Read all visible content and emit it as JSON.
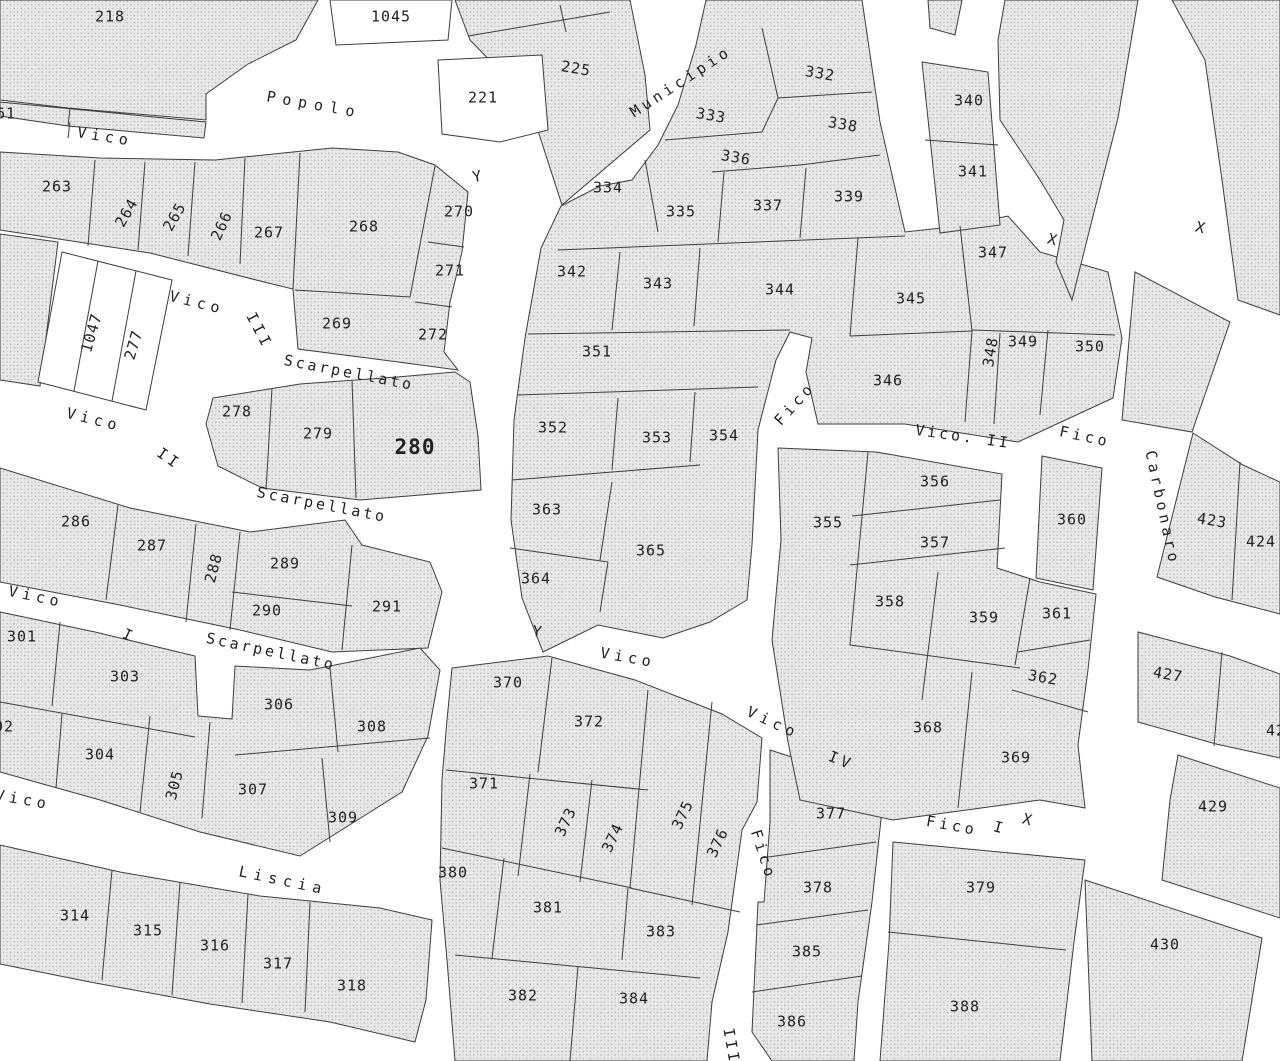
{
  "map": {
    "title": "cadastral-parcel-map",
    "background": "#ffffff",
    "boundary_line_color": "#3d3d3d",
    "hatch_base_color": "#e8e8e8",
    "hatch_dot_color": "#a8a8a8",
    "label_color": "#1f1f1f",
    "parcel_labels": [
      {
        "text": "218",
        "x": 110,
        "y": 17,
        "rot": 0
      },
      {
        "text": "1045",
        "x": 391,
        "y": 17,
        "rot": 0
      },
      {
        "text": "225",
        "x": 576,
        "y": 69,
        "rot": 10
      },
      {
        "text": "221",
        "x": 483,
        "y": 98,
        "rot": 0
      },
      {
        "text": "61",
        "x": 6,
        "y": 114,
        "rot": 0
      },
      {
        "text": "332",
        "x": 820,
        "y": 74,
        "rot": 10
      },
      {
        "text": "333",
        "x": 711,
        "y": 116,
        "rot": 10
      },
      {
        "text": "338",
        "x": 843,
        "y": 125,
        "rot": 10
      },
      {
        "text": "336",
        "x": 736,
        "y": 158,
        "rot": 10
      },
      {
        "text": "334",
        "x": 608,
        "y": 188,
        "rot": 0
      },
      {
        "text": "335",
        "x": 681,
        "y": 212,
        "rot": 0
      },
      {
        "text": "337",
        "x": 768,
        "y": 206,
        "rot": 0
      },
      {
        "text": "339",
        "x": 849,
        "y": 197,
        "rot": 0
      },
      {
        "text": "340",
        "x": 969,
        "y": 101,
        "rot": 0
      },
      {
        "text": "341",
        "x": 973,
        "y": 172,
        "rot": 0
      },
      {
        "text": "263",
        "x": 57,
        "y": 187,
        "rot": 0
      },
      {
        "text": "264",
        "x": 127,
        "y": 213,
        "rot": -60
      },
      {
        "text": "265",
        "x": 175,
        "y": 217,
        "rot": -60
      },
      {
        "text": "266",
        "x": 222,
        "y": 226,
        "rot": -65
      },
      {
        "text": "267",
        "x": 269,
        "y": 233,
        "rot": 0
      },
      {
        "text": "268",
        "x": 364,
        "y": 227,
        "rot": 0
      },
      {
        "text": "270",
        "x": 459,
        "y": 212,
        "rot": 0
      },
      {
        "text": "271",
        "x": 450,
        "y": 271,
        "rot": 0
      },
      {
        "text": "272",
        "x": 433,
        "y": 335,
        "rot": 0
      },
      {
        "text": "269",
        "x": 337,
        "y": 324,
        "rot": 0
      },
      {
        "text": "342",
        "x": 572,
        "y": 272,
        "rot": 0
      },
      {
        "text": "343",
        "x": 658,
        "y": 284,
        "rot": 0
      },
      {
        "text": "344",
        "x": 780,
        "y": 290,
        "rot": 0
      },
      {
        "text": "345",
        "x": 911,
        "y": 299,
        "rot": 0
      },
      {
        "text": "347",
        "x": 993,
        "y": 253,
        "rot": 0
      },
      {
        "text": "346",
        "x": 888,
        "y": 381,
        "rot": 0
      },
      {
        "text": "348",
        "x": 991,
        "y": 352,
        "rot": -80
      },
      {
        "text": "349",
        "x": 1023,
        "y": 342,
        "rot": 0
      },
      {
        "text": "350",
        "x": 1090,
        "y": 347,
        "rot": 0
      },
      {
        "text": "1047",
        "x": 92,
        "y": 333,
        "rot": -74
      },
      {
        "text": "277",
        "x": 134,
        "y": 345,
        "rot": -74
      },
      {
        "text": "351",
        "x": 597,
        "y": 352,
        "rot": 0
      },
      {
        "text": "352",
        "x": 553,
        "y": 428,
        "rot": 0
      },
      {
        "text": "353",
        "x": 657,
        "y": 438,
        "rot": 0
      },
      {
        "text": "354",
        "x": 724,
        "y": 436,
        "rot": 0
      },
      {
        "text": "278",
        "x": 237,
        "y": 412,
        "rot": 0
      },
      {
        "text": "279",
        "x": 318,
        "y": 434,
        "rot": 0
      },
      {
        "text": "280",
        "x": 415,
        "y": 448,
        "rot": 0,
        "big": true
      },
      {
        "text": "286",
        "x": 76,
        "y": 522,
        "rot": 0
      },
      {
        "text": "287",
        "x": 152,
        "y": 546,
        "rot": 0
      },
      {
        "text": "288",
        "x": 214,
        "y": 568,
        "rot": -75
      },
      {
        "text": "289",
        "x": 285,
        "y": 564,
        "rot": 0
      },
      {
        "text": "290",
        "x": 267,
        "y": 611,
        "rot": 0
      },
      {
        "text": "291",
        "x": 387,
        "y": 607,
        "rot": 0
      },
      {
        "text": "363",
        "x": 547,
        "y": 510,
        "rot": 0
      },
      {
        "text": "365",
        "x": 651,
        "y": 551,
        "rot": 0
      },
      {
        "text": "364",
        "x": 536,
        "y": 579,
        "rot": 0
      },
      {
        "text": "355",
        "x": 828,
        "y": 523,
        "rot": 0
      },
      {
        "text": "356",
        "x": 935,
        "y": 482,
        "rot": 0
      },
      {
        "text": "357",
        "x": 935,
        "y": 543,
        "rot": 0
      },
      {
        "text": "360",
        "x": 1072,
        "y": 520,
        "rot": 0
      },
      {
        "text": "358",
        "x": 890,
        "y": 602,
        "rot": 0
      },
      {
        "text": "359",
        "x": 984,
        "y": 618,
        "rot": 0
      },
      {
        "text": "361",
        "x": 1057,
        "y": 614,
        "rot": 0
      },
      {
        "text": "362",
        "x": 1043,
        "y": 678,
        "rot": 10
      },
      {
        "text": "423",
        "x": 1212,
        "y": 521,
        "rot": 10
      },
      {
        "text": "424",
        "x": 1261,
        "y": 542,
        "rot": 0
      },
      {
        "text": "427",
        "x": 1168,
        "y": 675,
        "rot": 10
      },
      {
        "text": "42",
        "x": 1276,
        "y": 731,
        "rot": 0
      },
      {
        "text": "301",
        "x": 22,
        "y": 637,
        "rot": 0
      },
      {
        "text": "303",
        "x": 125,
        "y": 677,
        "rot": 0
      },
      {
        "text": "306",
        "x": 279,
        "y": 705,
        "rot": 0
      },
      {
        "text": "308",
        "x": 372,
        "y": 727,
        "rot": 0
      },
      {
        "text": "02",
        "x": 4,
        "y": 727,
        "rot": 0
      },
      {
        "text": "304",
        "x": 100,
        "y": 755,
        "rot": 0
      },
      {
        "text": "305",
        "x": 175,
        "y": 785,
        "rot": -75
      },
      {
        "text": "307",
        "x": 253,
        "y": 790,
        "rot": 0
      },
      {
        "text": "309",
        "x": 343,
        "y": 818,
        "rot": 0
      },
      {
        "text": "370",
        "x": 508,
        "y": 683,
        "rot": 0
      },
      {
        "text": "372",
        "x": 589,
        "y": 722,
        "rot": 0
      },
      {
        "text": "371",
        "x": 484,
        "y": 784,
        "rot": 0
      },
      {
        "text": "373",
        "x": 566,
        "y": 822,
        "rot": -65
      },
      {
        "text": "374",
        "x": 613,
        "y": 838,
        "rot": -65
      },
      {
        "text": "375",
        "x": 683,
        "y": 815,
        "rot": -65
      },
      {
        "text": "376",
        "x": 718,
        "y": 843,
        "rot": -65
      },
      {
        "text": "368",
        "x": 928,
        "y": 728,
        "rot": 0
      },
      {
        "text": "369",
        "x": 1016,
        "y": 758,
        "rot": 0
      },
      {
        "text": "429",
        "x": 1213,
        "y": 807,
        "rot": 0
      },
      {
        "text": "377",
        "x": 831,
        "y": 814,
        "rot": 0
      },
      {
        "text": "378",
        "x": 818,
        "y": 888,
        "rot": 0
      },
      {
        "text": "385",
        "x": 807,
        "y": 952,
        "rot": 0
      },
      {
        "text": "386",
        "x": 792,
        "y": 1022,
        "rot": 0
      },
      {
        "text": "379",
        "x": 981,
        "y": 888,
        "rot": 0
      },
      {
        "text": "388",
        "x": 965,
        "y": 1007,
        "rot": 0
      },
      {
        "text": "380",
        "x": 453,
        "y": 873,
        "rot": 0
      },
      {
        "text": "381",
        "x": 548,
        "y": 908,
        "rot": 0
      },
      {
        "text": "383",
        "x": 661,
        "y": 932,
        "rot": 0
      },
      {
        "text": "382",
        "x": 523,
        "y": 996,
        "rot": 0
      },
      {
        "text": "384",
        "x": 634,
        "y": 999,
        "rot": 0
      },
      {
        "text": "314",
        "x": 75,
        "y": 916,
        "rot": 0
      },
      {
        "text": "315",
        "x": 148,
        "y": 931,
        "rot": 0
      },
      {
        "text": "316",
        "x": 215,
        "y": 946,
        "rot": 0
      },
      {
        "text": "317",
        "x": 278,
        "y": 964,
        "rot": 0
      },
      {
        "text": "318",
        "x": 352,
        "y": 986,
        "rot": 0
      },
      {
        "text": "430",
        "x": 1165,
        "y": 945,
        "rot": 0
      }
    ],
    "street_labels": [
      {
        "text": "Popolo",
        "x": 314,
        "y": 105,
        "rot": 10,
        "ls": 7
      },
      {
        "text": "Municipio",
        "x": 681,
        "y": 82,
        "rot": -33,
        "ls": 4
      },
      {
        "text": "Vico",
        "x": 105,
        "y": 137,
        "rot": 9,
        "ls": 5
      },
      {
        "text": "Vico",
        "x": 197,
        "y": 303,
        "rot": 14,
        "ls": 5
      },
      {
        "text": "III",
        "x": 259,
        "y": 331,
        "rot": 62,
        "ls": 4
      },
      {
        "text": "Scarpellato",
        "x": 349,
        "y": 373,
        "rot": 11,
        "ls": 3
      },
      {
        "text": "Vico",
        "x": 94,
        "y": 420,
        "rot": 14,
        "ls": 5
      },
      {
        "text": "II",
        "x": 169,
        "y": 459,
        "rot": 35,
        "ls": 4
      },
      {
        "text": "Scarpellato",
        "x": 322,
        "y": 505,
        "rot": 11,
        "ls": 3
      },
      {
        "text": "Vico",
        "x": 36,
        "y": 597,
        "rot": 12,
        "ls": 5
      },
      {
        "text": "I",
        "x": 129,
        "y": 636,
        "rot": 25,
        "ls": 4
      },
      {
        "text": "Scarpellato",
        "x": 271,
        "y": 652,
        "rot": 12,
        "ls": 3
      },
      {
        "text": "Vico",
        "x": 23,
        "y": 800,
        "rot": 10,
        "ls": 5
      },
      {
        "text": "Liscia",
        "x": 283,
        "y": 881,
        "rot": 12,
        "ls": 6
      },
      {
        "text": "Vico",
        "x": 628,
        "y": 658,
        "rot": 10,
        "ls": 5
      },
      {
        "text": "Vico",
        "x": 773,
        "y": 723,
        "rot": 25,
        "ls": 5
      },
      {
        "text": "IV",
        "x": 841,
        "y": 761,
        "rot": 22,
        "ls": 4
      },
      {
        "text": "Fico",
        "x": 795,
        "y": 404,
        "rot": -48,
        "ls": 4
      },
      {
        "text": "Vico. II",
        "x": 963,
        "y": 437,
        "rot": 8,
        "ls": 3
      },
      {
        "text": "Fico",
        "x": 1085,
        "y": 437,
        "rot": 12,
        "ls": 4
      },
      {
        "text": "Carbonaro",
        "x": 1162,
        "y": 508,
        "rot": 78,
        "ls": 4
      },
      {
        "text": "Fico",
        "x": 763,
        "y": 855,
        "rot": 72,
        "ls": 4
      },
      {
        "text": "Fico",
        "x": 952,
        "y": 826,
        "rot": 10,
        "ls": 4
      },
      {
        "text": "I",
        "x": 999,
        "y": 828,
        "rot": 15,
        "ls": 2
      },
      {
        "text": "III",
        "x": 731,
        "y": 1046,
        "rot": 80,
        "ls": 3
      }
    ],
    "survey_marks": [
      {
        "glyph": "Y",
        "x": 477,
        "y": 177,
        "rot": -10
      },
      {
        "glyph": "Y",
        "x": 537,
        "y": 632,
        "rot": 8
      },
      {
        "glyph": "X",
        "x": 1052,
        "y": 240,
        "rot": 15
      },
      {
        "glyph": "X",
        "x": 1200,
        "y": 228,
        "rot": 15
      },
      {
        "glyph": "X",
        "x": 1027,
        "y": 820,
        "rot": 15
      }
    ]
  }
}
